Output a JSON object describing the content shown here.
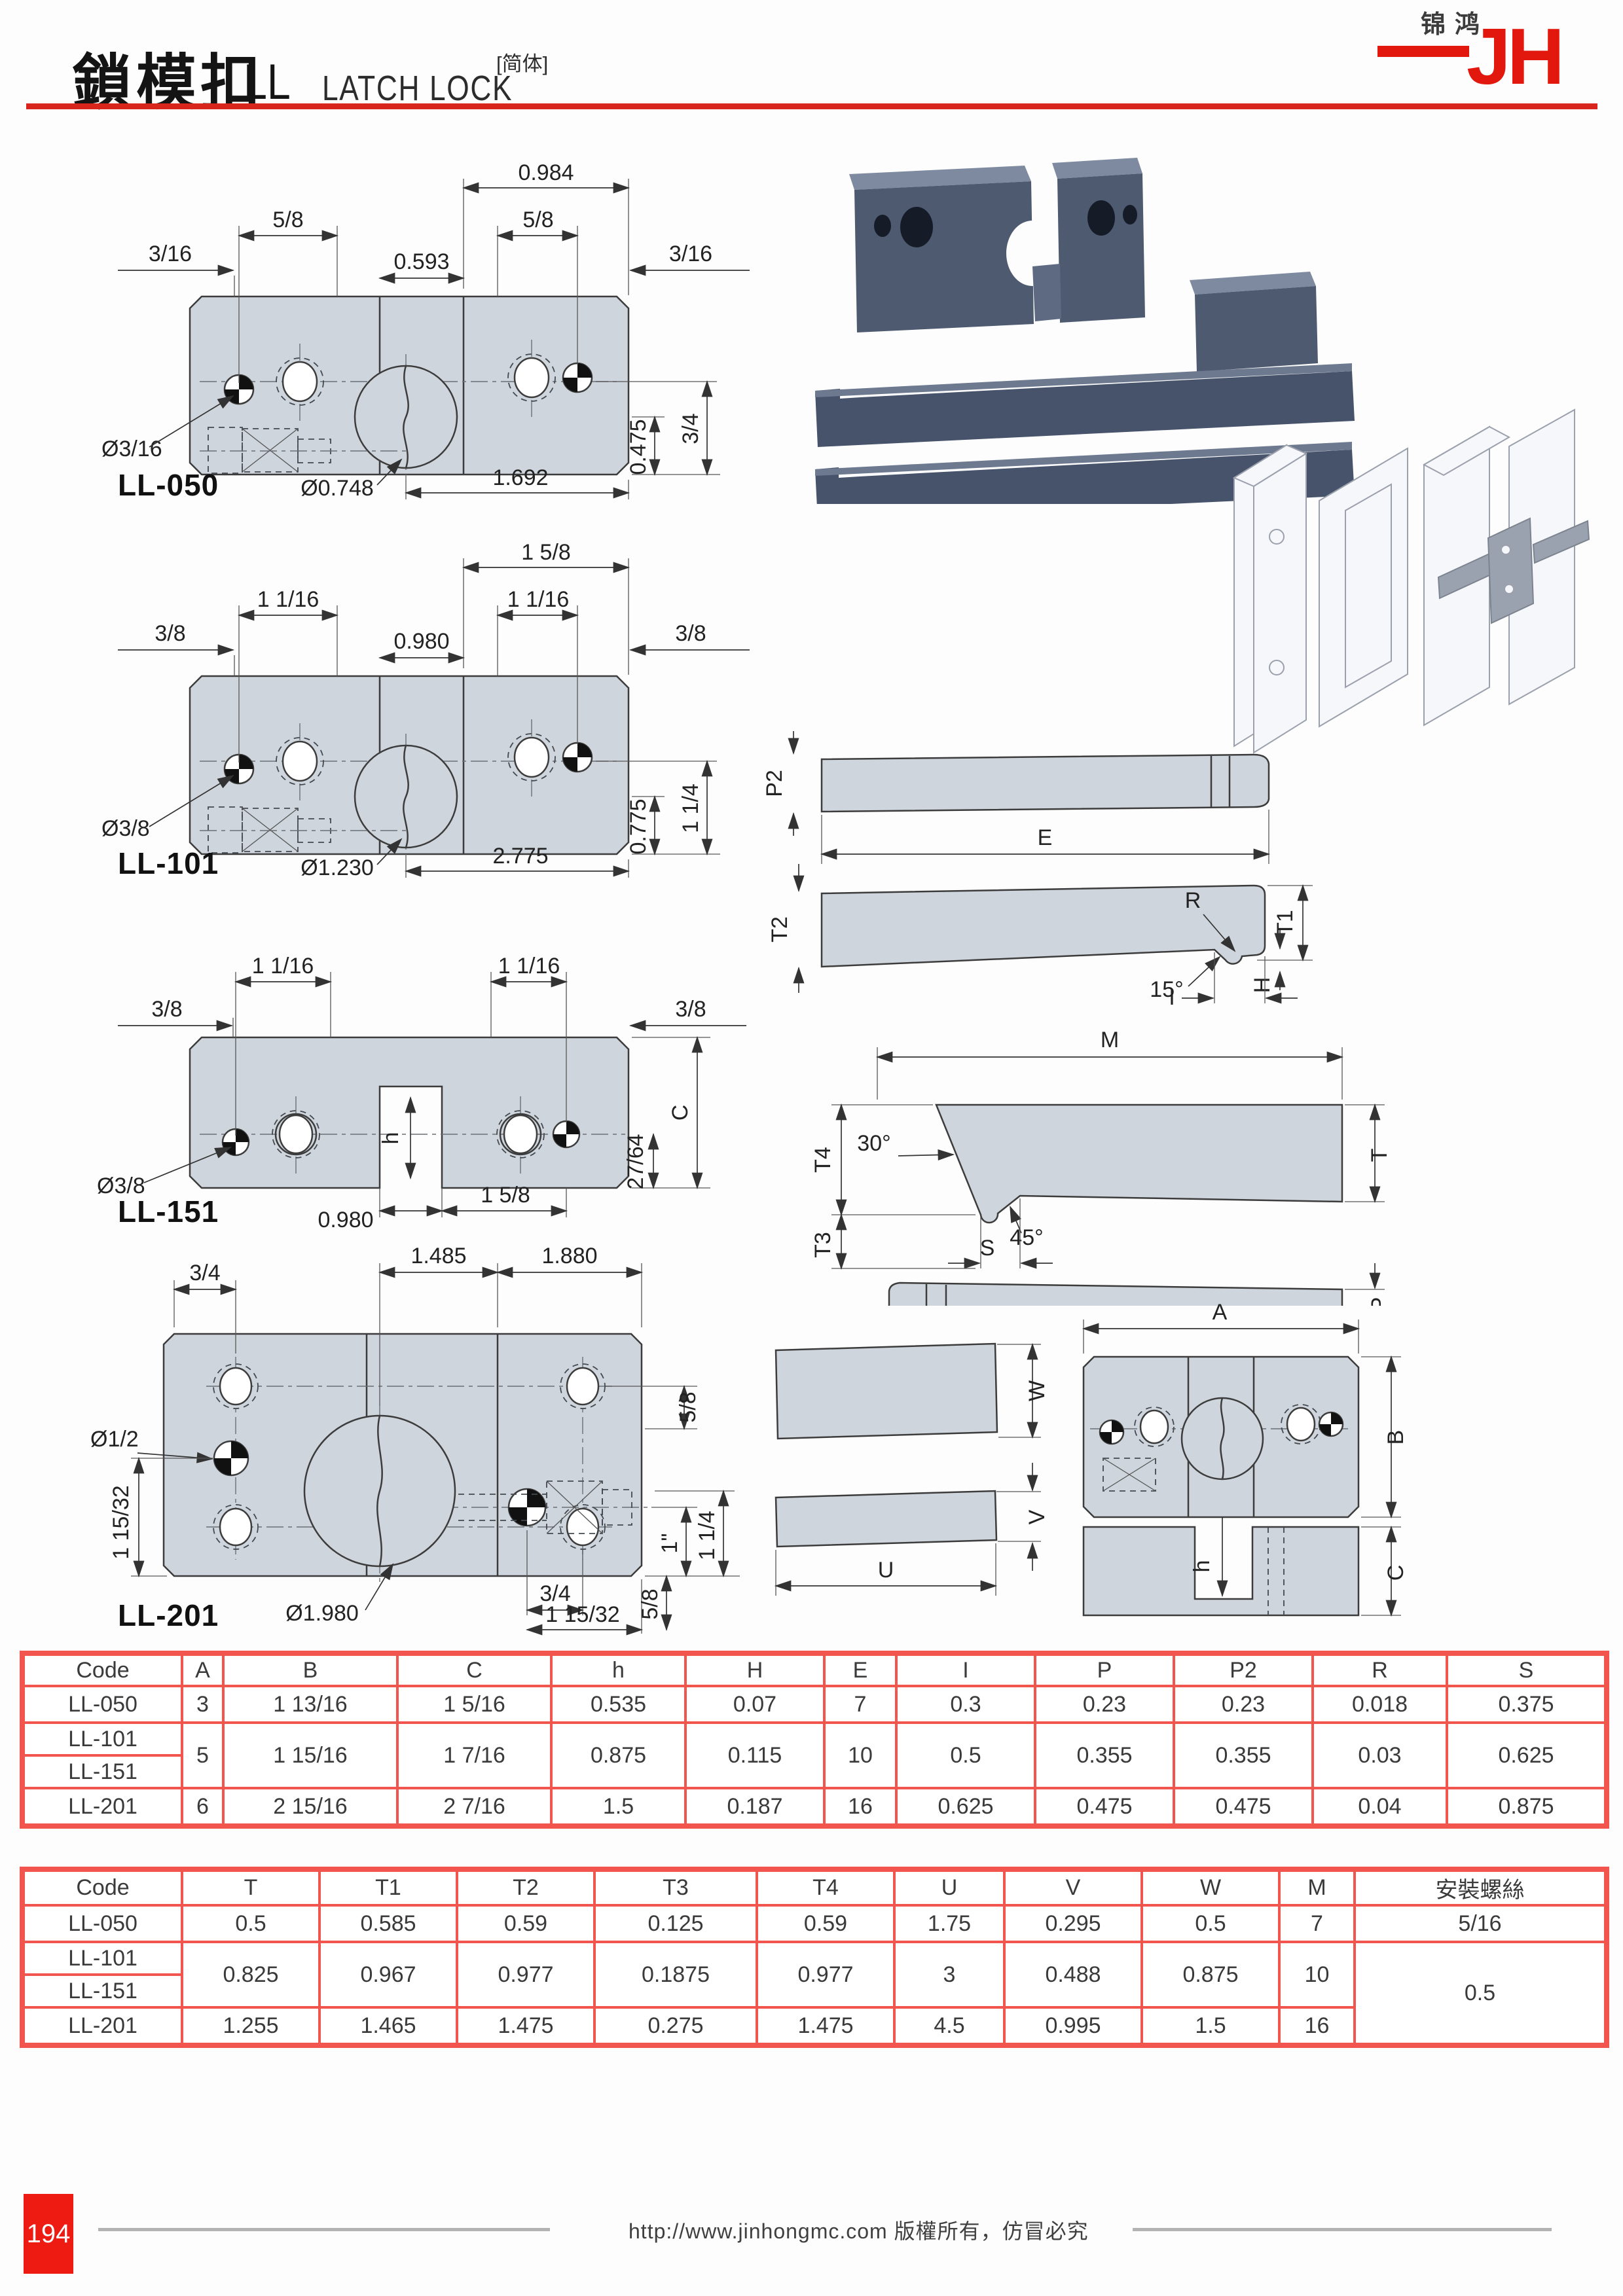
{
  "header": {
    "title_zh": "鎖模扣",
    "series": "LL",
    "title_en": "LATCH LOCK",
    "note": "[简体]",
    "logo_text": "锦鸿",
    "logo_mark": "JH"
  },
  "drawings": {
    "ll050": {
      "label": "LL-050",
      "top_width": "0.984",
      "pitch_left": "5/8",
      "pitch_right": "5/8",
      "edge_left": "3/16",
      "center_span": "0.593",
      "edge_right": "3/16",
      "pin_dia": "Ø3/16",
      "latch_dia": "Ø0.748",
      "bottom_span": "1.692",
      "height_inner": "0.475",
      "height_outer": "3/4"
    },
    "ll101": {
      "label": "LL-101",
      "top_width": "1 5/8",
      "pitch_left": "1 1/16",
      "pitch_right": "1 1/16",
      "edge_left": "3/8",
      "center_span": "0.980",
      "edge_right": "3/8",
      "pin_dia": "Ø3/8",
      "latch_dia": "Ø1.230",
      "bottom_span": "2.775",
      "height_inner": "0.775",
      "height_outer": "1 1/4"
    },
    "ll151": {
      "label": "LL-151",
      "pitch_left": "1 1/16",
      "pitch_right": "1 1/16",
      "edge_left": "3/8",
      "edge_right": "3/8",
      "pin_dia": "Ø3/8",
      "slot_depth": "h",
      "height": "C",
      "slot_width": "0.980",
      "pitch_bottom": "1 5/8",
      "step_height": "27/64"
    },
    "ll201": {
      "label": "LL-201",
      "edge_top": "3/4",
      "span_left": "1.485",
      "span_right": "1.880",
      "pitch_top_right": "5/8",
      "pin_dia": "Ø1/2",
      "pitch_left": "1 15/32",
      "latch_dia": "Ø1.980",
      "edge_bottom": "3/4",
      "offset_right": "1\"",
      "height_outer": "1 1/4",
      "pitch_bottom_right": "5/8",
      "pitch_bottom": "1 15/32"
    }
  },
  "diagrams": {
    "strike_plate": {
      "thickness": "P2",
      "length": "E"
    },
    "latch_bar": {
      "thickness": "T2",
      "radius": "R",
      "tip_height": "T1",
      "angle": "15°",
      "hook_height": "H",
      "hook_offset": "I"
    },
    "catch_bar": {
      "length": "M",
      "front_height": "T4",
      "angle_top": "30°",
      "angle_tip": "45°",
      "nose_width": "S",
      "nose_height": "T3",
      "thickness": "T"
    },
    "spring_plate": {
      "thickness": "P"
    },
    "block_plan": {
      "width": "A",
      "depth": "B"
    },
    "plate_w": {
      "height": "W"
    },
    "plate_v": {
      "height": "V",
      "length": "U"
    },
    "block_front": {
      "slot_depth": "h",
      "height": "C"
    }
  },
  "table1": {
    "headers": [
      "Code",
      "A",
      "B",
      "C",
      "h",
      "H",
      "E",
      "I",
      "P",
      "P2",
      "R",
      "S"
    ],
    "row050": [
      "LL-050",
      "3",
      "1 13/16",
      "1 5/16",
      "0.535",
      "0.07",
      "7",
      "0.3",
      "0.23",
      "0.23",
      "0.018",
      "0.375"
    ],
    "code101": "LL-101",
    "code151": "LL-151",
    "shared": [
      "5",
      "1 15/16",
      "1 7/16",
      "0.875",
      "0.115",
      "10",
      "0.5",
      "0.355",
      "0.355",
      "0.03",
      "0.625"
    ],
    "row201": [
      "LL-201",
      "6",
      "2 15/16",
      "2 7/16",
      "1.5",
      "0.187",
      "16",
      "0.625",
      "0.475",
      "0.475",
      "0.04",
      "0.875"
    ]
  },
  "table2": {
    "headers": [
      "Code",
      "T",
      "T1",
      "T2",
      "T3",
      "T4",
      "U",
      "V",
      "W",
      "M",
      "安裝螺絲"
    ],
    "row050": [
      "LL-050",
      "0.5",
      "0.585",
      "0.59",
      "0.125",
      "0.59",
      "1.75",
      "0.295",
      "0.5",
      "7",
      "5/16"
    ],
    "code101": "LL-101",
    "code151": "LL-151",
    "shared": [
      "0.825",
      "0.967",
      "0.977",
      "0.1875",
      "0.977",
      "3",
      "0.488",
      "0.875",
      "10"
    ],
    "row201": [
      "LL-201",
      "1.255",
      "1.465",
      "1.475",
      "0.275",
      "1.475",
      "4.5",
      "0.995",
      "1.5",
      "16"
    ],
    "screw_shared": "0.5"
  },
  "footer": {
    "page": "194",
    "copyright": "http://www.jinhongmc.com 版權所有，仿冒必究"
  }
}
